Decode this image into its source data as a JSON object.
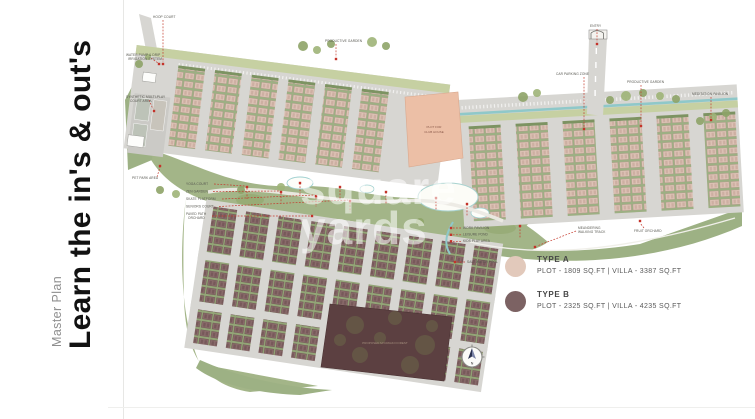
{
  "page": {
    "eyebrow": "Master Plan",
    "title": "Learn the in's & out's"
  },
  "watermark": {
    "line1": "square",
    "line2": "yards"
  },
  "legend": {
    "items": [
      {
        "label": "TYPE A",
        "detail": "PLOT - 1809 SQ.FT | VILLA - 3387 SQ.FT",
        "color": "#e2c9bb"
      },
      {
        "label": "TYPE B",
        "detail": "PLOT - 2325 SQ.FT | VILLA - 4235 SQ.FT",
        "color": "#7c6263"
      }
    ]
  },
  "compass": {
    "north_label": "N"
  },
  "plan": {
    "clubhouse_label_line1": "PLOT FOR",
    "clubhouse_label_line2": "CLUB HOUSE",
    "forest_label": "PROPOSED MIYAWAKI FOREST",
    "colors": {
      "road": "#d7d6d2",
      "green": "#a3b588",
      "type_a_plot": "#dec3b6",
      "type_b_plot": "#8a6b6b",
      "clubhouse": "#ecbfa6",
      "forest": "#5c4041",
      "water": "#8fc8c9",
      "marker_red": "#c4392c"
    },
    "labels": [
      "WATER PUMP & DRIP",
      "IRRIGATION SYSTEM",
      "HOOP COURT",
      "PRODUCTIVE GARDEN",
      "CAR PARKING ZONE",
      "PRODUCTIVE GARDEN",
      "MEDITATION PAVILION",
      "SYNTHETIC MULTI-PLAY",
      "COURT AREA",
      "PET PARK AREA",
      "YOGA COURT",
      "ZEN GARDEN",
      "SKATE PLATFORM",
      "SENIORS COURT",
      "PAVED PATH",
      "ORCHARD",
      "WORK PAVILION",
      "LEISURE POND",
      "KIDS PLAY AREA",
      "SALT WATER POOL",
      "MEANDERING",
      "WALKING TRACK",
      "FRUIT ORCHARD",
      "ENTRY"
    ]
  }
}
